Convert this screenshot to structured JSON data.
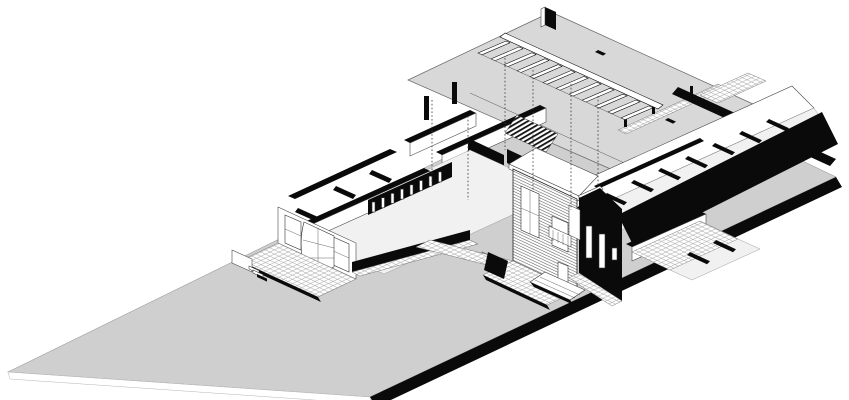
{
  "meta": {
    "type": "architectural-axonometric-cutaway-drawing",
    "text_content": []
  },
  "colors": {
    "background": "#ffffff",
    "lawn": "#cfcfcf",
    "roof": "#d8d8d8",
    "ink": "#0a0a0a",
    "face": "#ffffff",
    "floor": "#f1f1f1",
    "line": "#3a3a3a"
  },
  "scene": {
    "parts": [
      "site-plane-lawn",
      "site-slab-edge",
      "site-boundary-black-band",
      "floating-roof-plane",
      "exposed-rafter-trusses",
      "ridge-beam",
      "chimney",
      "roof-walkway-tiles",
      "parapet-wall",
      "right-wing-cutaway-rooms",
      "right-wing-black-facade",
      "left-wing-cutaway-rooms",
      "window-colonnade",
      "west-facade-bay-window",
      "garden-terrace",
      "terrace-steps",
      "brick-gable-house",
      "balcony-planter",
      "dark-gable-house",
      "courtyard-tiles",
      "stair-hatch",
      "projection-dotted-lines"
    ]
  }
}
